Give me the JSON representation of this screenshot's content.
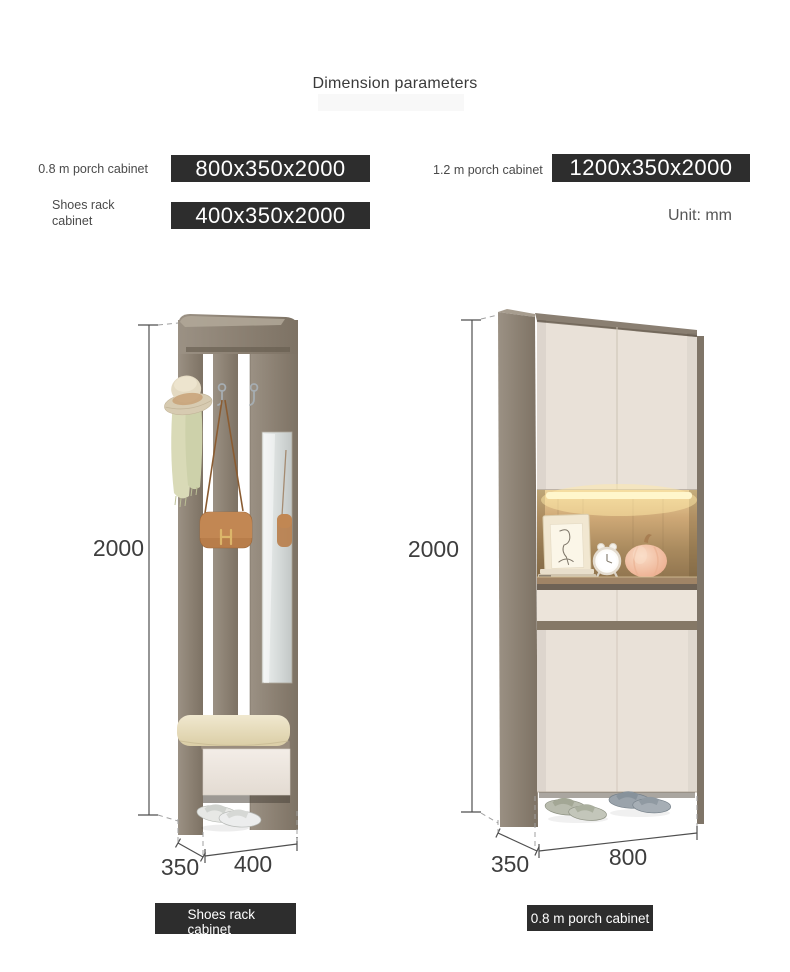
{
  "page": {
    "title": "Dimension parameters",
    "unit_label": "Unit: mm"
  },
  "specs": [
    {
      "label": "0.8 m porch cabinet",
      "value": "800x350x2000"
    },
    {
      "label": "1.2 m porch cabinet",
      "value": "1200x350x2000"
    },
    {
      "label": "Shoes rack cabinet",
      "value": "400x350x2000"
    }
  ],
  "figures": {
    "shoes_rack": {
      "caption": "Shoes rack cabinet",
      "height_mm": "2000",
      "width_mm": "400",
      "depth_mm": "350"
    },
    "porch_cabinet": {
      "caption": "0.8 m porch cabinet",
      "height_mm": "2000",
      "width_mm": "800",
      "depth_mm": "350"
    }
  },
  "colors": {
    "label_box_bg": "#2d2d2d",
    "label_box_text": "#ffffff",
    "heading_text": "#3a3a3a",
    "spec_label_text": "#4a4a4a",
    "dimension_text": "#3e3e3e",
    "dimension_line": "#4f4f4f",
    "wood": "#8d8276",
    "door_front": "#e9e1d8",
    "cushion": "#e6dcbe",
    "shelf_glow": "#fff3c2",
    "handbag": "#b87d4a"
  }
}
